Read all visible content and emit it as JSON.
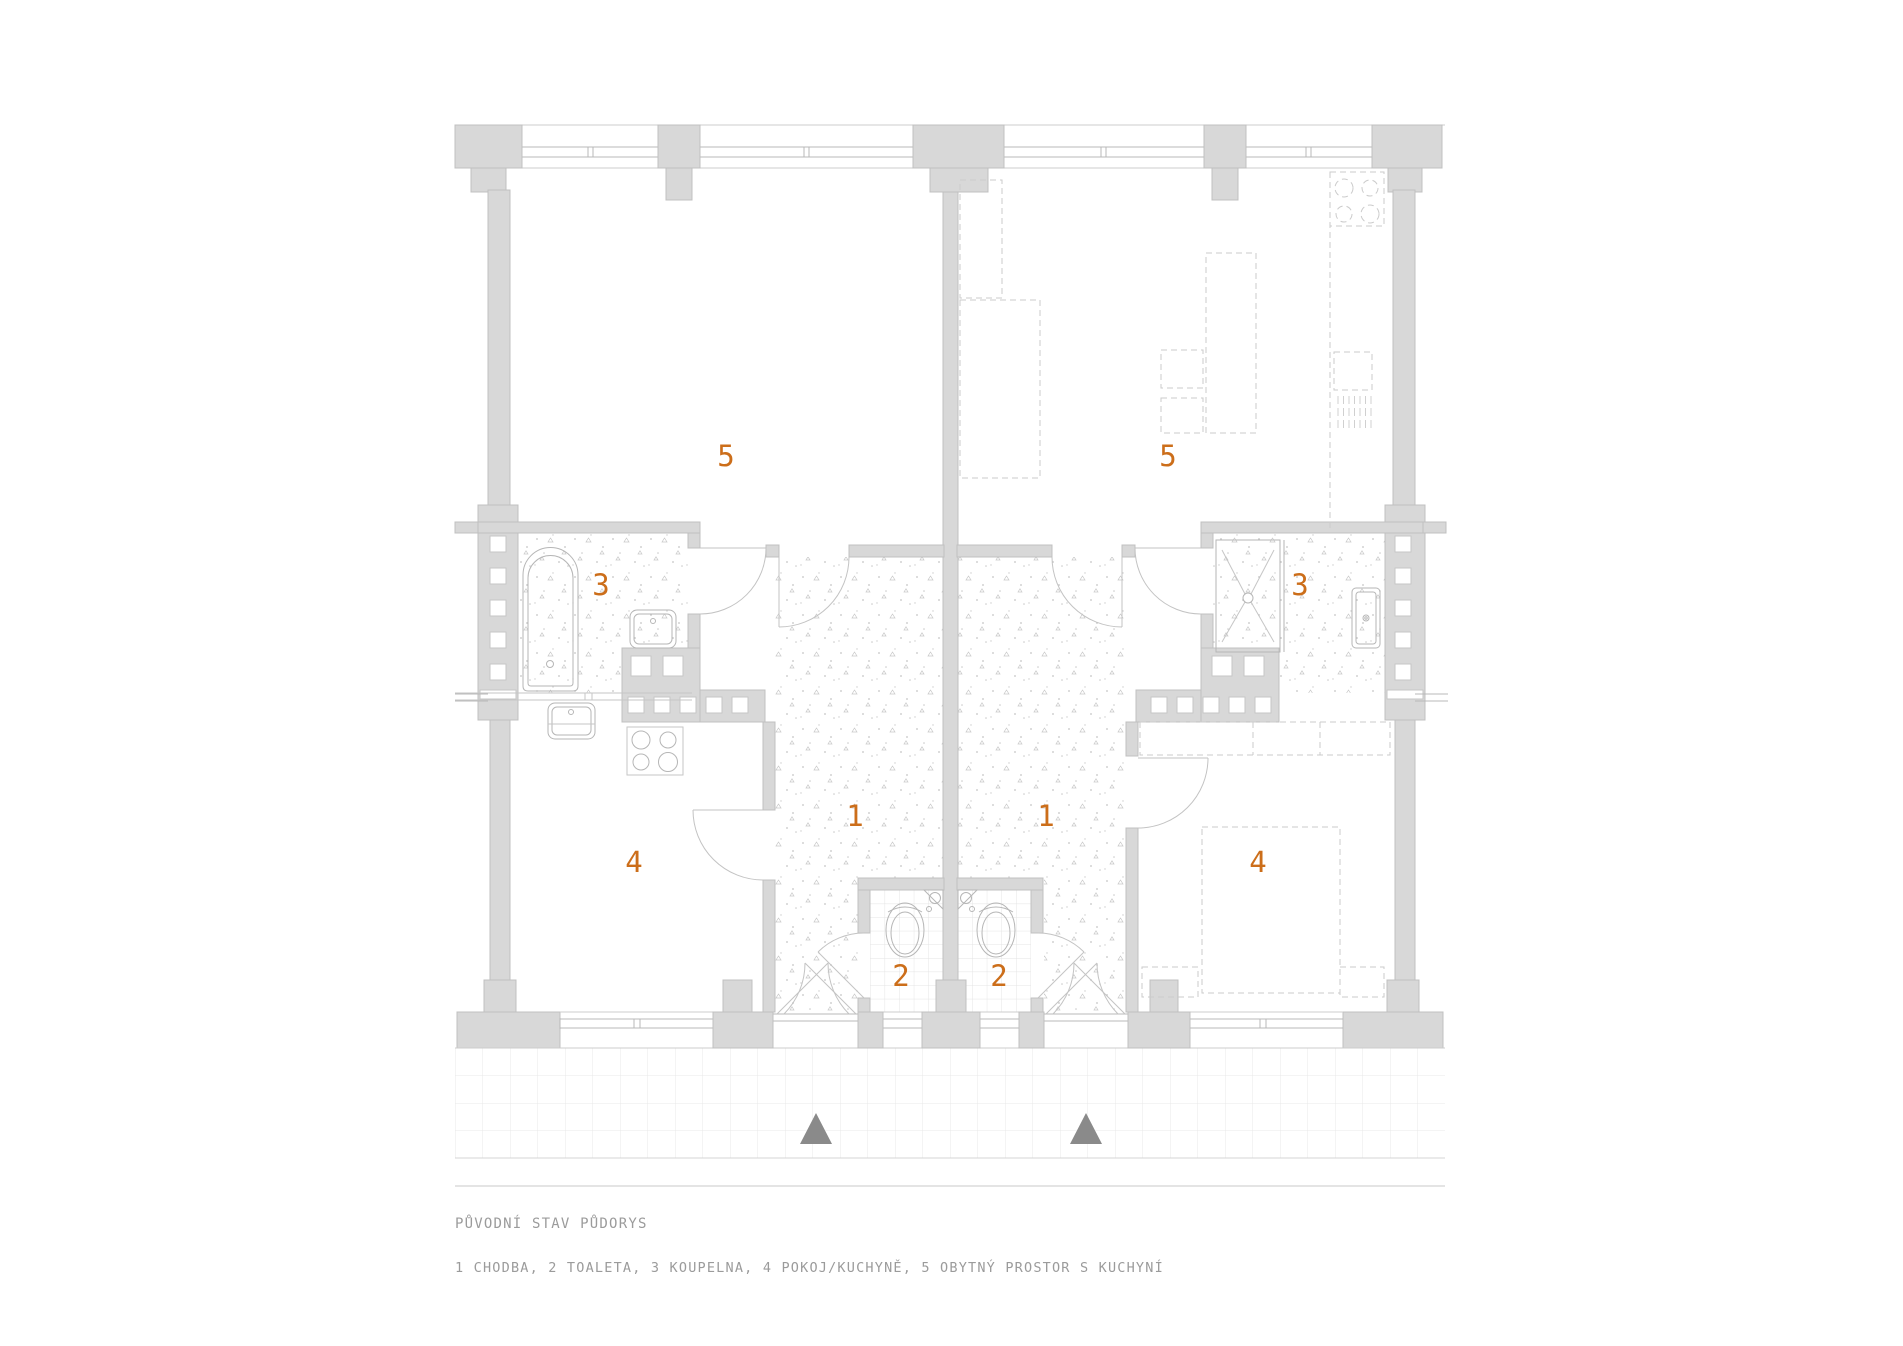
{
  "document": {
    "title": "PŮVODNÍ STAV PŮDORYS",
    "legend": "1 CHODBA, 2 TOALETA, 3 KOUPELNA, 4 POKOJ/KUCHYNĚ, 5 OBYTNÝ PROSTOR S KUCHYNÍ"
  },
  "legend_items": [
    {
      "number": "1",
      "name": "CHODBA"
    },
    {
      "number": "2",
      "name": "TOALETA"
    },
    {
      "number": "3",
      "name": "KOUPELNA"
    },
    {
      "number": "4",
      "name": "POKOJ/KUCHYNĚ"
    },
    {
      "number": "5",
      "name": "OBYTNÝ PROSTOR S KUCHYNÍ"
    }
  ],
  "room_labels": {
    "left_living": "5",
    "right_living": "5",
    "left_bathroom": "3",
    "right_bathroom": "3",
    "left_hall": "1",
    "right_hall": "1",
    "left_room": "4",
    "right_room": "4",
    "left_wc": "2",
    "right_wc": "2"
  },
  "icons": {
    "entrance_arrow_left": "up-triangle",
    "entrance_arrow_right": "up-triangle"
  },
  "colors": {
    "label_orange": "#cc6e1a",
    "wall_gray": "#d8d8d8",
    "line_gray": "#b6b6b6",
    "text_gray": "#9b9b9b",
    "arrow_gray": "#8a8a8a"
  }
}
